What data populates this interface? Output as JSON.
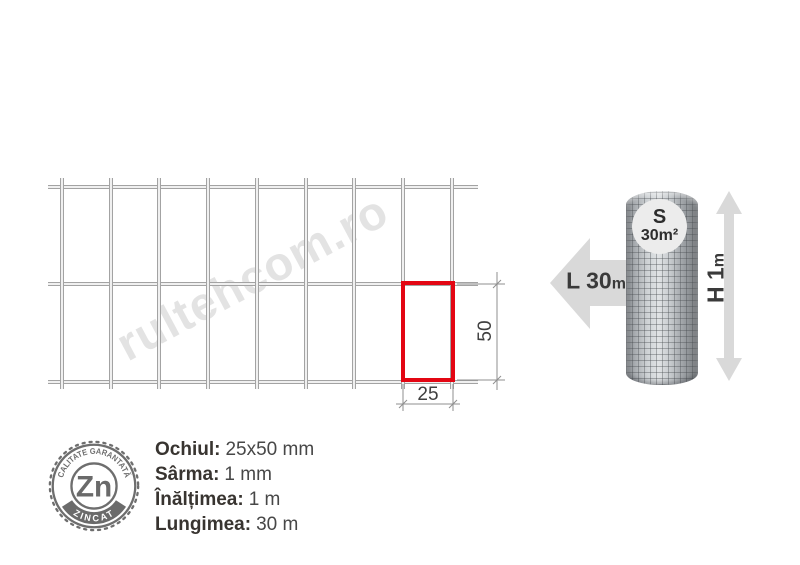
{
  "watermark": "rultehcom.ro",
  "diagram": {
    "dim_width_label": "25",
    "dim_height_label": "50"
  },
  "roll": {
    "surface_symbol": "S",
    "surface_value": "30m²",
    "length_label": "L 30",
    "length_unit": "m",
    "height_label": "H 1",
    "height_unit": "m"
  },
  "badge": {
    "element": "Zn",
    "top_text": "CALITATE GARANTATĂ",
    "bottom_text": "ZINCAT"
  },
  "specs": {
    "items": [
      {
        "label": "Ochiul:",
        "value": "25x50 mm"
      },
      {
        "label": "Sârma:",
        "value": "1 mm"
      },
      {
        "label": "Înălțimea:",
        "value": "1 m"
      },
      {
        "label": "Lungimea:",
        "value": "30 m"
      }
    ]
  },
  "colors": {
    "accent_red": "#e30613",
    "arrow_gray": "#d9d9d9",
    "wire_gray": "#a3a3a3",
    "badge_gray": "#6e6e6e",
    "watermark_gray": "#e3e3e3"
  }
}
